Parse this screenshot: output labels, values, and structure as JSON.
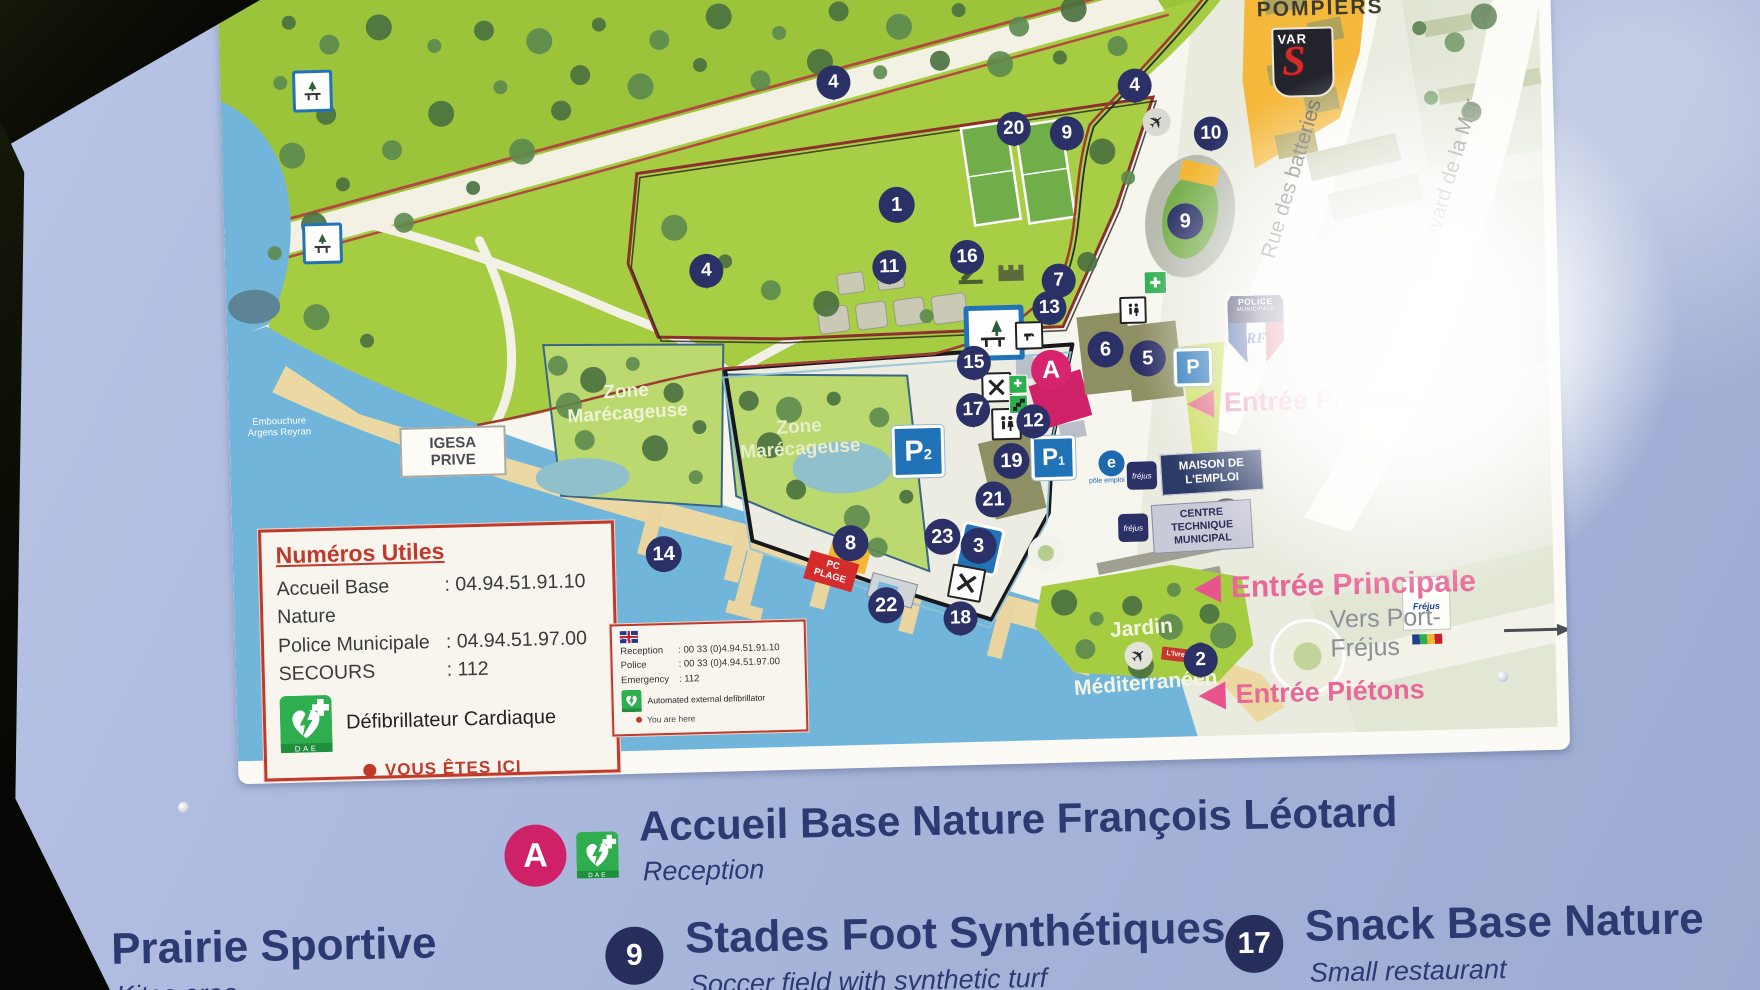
{
  "palette": {
    "panel_blue": "#aebbdf",
    "navy": "#2b3166",
    "legend_navy": "#2c3a72",
    "pink_accent": "#d6246e",
    "entrance_pink": "#e8548c",
    "park_green": "#a6cc41",
    "marsh_green": "#bcd96f",
    "water_blue": "#72b5da",
    "sand": "#ecd8a2",
    "building_yellow": "#f4b83b",
    "parking_blue": "#2173b8",
    "alert_red": "#c0392b",
    "dae_green": "#2fae4f"
  },
  "map": {
    "labels": {
      "pompiers": "POMPIERS",
      "var_logo": "VAR",
      "rue_des_batteries": "Rue des batteries",
      "boulevard_de_la_mer": "Boulevard de la Mer",
      "zone_marecageuse_1": "Zone Marécageuse",
      "zone_marecageuse_2": "Zone Marécageuse",
      "igesa": "IGESA PRIVE",
      "embouchure": "Embouchure Argens Reyran",
      "police_line1": "POLICE",
      "police_line2": "MUNICIPALE",
      "police_rf": "RF",
      "maison_emploi": "MAISON DE L'EMPLOI",
      "centre_technique": "CENTRE TECHNIQUE MUNICIPAL",
      "pole_emploi": "pôle emploi",
      "frejus_small": "fréjus",
      "jardin_line1": "Jardin",
      "jardin_line2": "Méditerranéen",
      "pc_plage": "PC PLAGE",
      "livre_de": "L'îvre de",
      "frejus_logo": "Fréjus",
      "entree_pietons_top": "Entrée Piétons",
      "entree_principale": "Entrée Principale",
      "vers_port_frejus": "Vers Port-Fréjus",
      "entree_pietons_bottom": "Entrée Piétons"
    },
    "info_box": {
      "title": "Numéros Utiles",
      "rows": [
        {
          "label": "Accueil Base Nature",
          "value": ": 04.94.51.91.10"
        },
        {
          "label": "Police Municipale",
          "value": ": 04.94.51.97.00"
        },
        {
          "label": "SECOURS",
          "value": ": 112"
        }
      ],
      "dae_label": "Défibrillateur Cardiaque",
      "dae_logo_text": "DAE",
      "you_are_here": "VOUS ÊTES ICI"
    },
    "info_box_en": {
      "rows": [
        {
          "label": "Reception",
          "value": ": 00 33 (0)4.94.51.91.10"
        },
        {
          "label": "Police",
          "value": ": 00 33 (0)4.94.51.97.00"
        },
        {
          "label": "Emergency",
          "value": ": 112"
        }
      ],
      "dae_label": "Automated external defibrillator",
      "you_are_here": "You are here"
    },
    "markers": [
      {
        "label": "4",
        "kind": "pin",
        "x": 613,
        "y": 109
      },
      {
        "label": "20",
        "kind": "pin",
        "x": 792,
        "y": 160
      },
      {
        "label": "9",
        "kind": "pin",
        "x": 845,
        "y": 166
      },
      {
        "label": "4",
        "kind": "pin",
        "x": 914,
        "y": 120
      },
      {
        "label": "10",
        "kind": "pin",
        "x": 989,
        "y": 170
      },
      {
        "label": "1",
        "kind": "circle",
        "x": 673,
        "y": 233
      },
      {
        "label": "9",
        "kind": "circle",
        "x": 961,
        "y": 257
      },
      {
        "label": "4",
        "kind": "pin",
        "x": 481,
        "y": 294
      },
      {
        "label": "11",
        "kind": "pin",
        "x": 664,
        "y": 295
      },
      {
        "label": "16",
        "kind": "pin",
        "x": 742,
        "y": 287
      },
      {
        "label": "7",
        "kind": "pin",
        "x": 833,
        "y": 313
      },
      {
        "label": "13",
        "kind": "pin",
        "x": 823,
        "y": 340
      },
      {
        "label": "15",
        "kind": "pin",
        "x": 746,
        "y": 393
      },
      {
        "label": "17",
        "kind": "pin",
        "x": 744,
        "y": 440
      },
      {
        "label": "12",
        "kind": "pin",
        "x": 804,
        "y": 453
      },
      {
        "label": "19",
        "kind": "circle",
        "x": 781,
        "y": 492
      },
      {
        "label": "21",
        "kind": "circle",
        "x": 762,
        "y": 530
      },
      {
        "label": "6",
        "kind": "circle",
        "x": 878,
        "y": 383
      },
      {
        "label": "5",
        "kind": "circle",
        "x": 920,
        "y": 393
      },
      {
        "label": "14",
        "kind": "circle",
        "x": 431,
        "y": 576
      },
      {
        "label": "8",
        "kind": "circle",
        "x": 618,
        "y": 570
      },
      {
        "label": "23",
        "kind": "circle",
        "x": 710,
        "y": 566
      },
      {
        "label": "3",
        "kind": "circle",
        "x": 746,
        "y": 576
      },
      {
        "label": "22",
        "kind": "circle",
        "x": 652,
        "y": 633
      },
      {
        "label": "18",
        "kind": "pin",
        "x": 726,
        "y": 648
      },
      {
        "label": "2",
        "kind": "pin",
        "x": 965,
        "y": 696
      },
      {
        "label": "A",
        "kind": "pin-pink",
        "x": 823,
        "y": 402
      }
    ],
    "parking": [
      {
        "label": "P",
        "sub": "",
        "x": 965,
        "y": 403,
        "size": 32
      },
      {
        "label": "P",
        "sub": "1",
        "x": 823,
        "y": 490,
        "size": 38
      },
      {
        "label": "P",
        "sub": "2",
        "x": 688,
        "y": 480,
        "size": 46
      }
    ]
  },
  "legend": {
    "header": {
      "badge": "A",
      "title": "Accueil Base Nature François Léotard",
      "subtitle": "Reception"
    },
    "items": [
      {
        "badge": "1",
        "title": "Prairie Sportive",
        "subtitle": "Kites area"
      },
      {
        "badge": "9",
        "title": "Stades Foot Synthétiques",
        "subtitle": "Soccer field with synthetic turf"
      },
      {
        "badge": "17",
        "title": "Snack Base Nature",
        "subtitle": "Small restaurant"
      }
    ]
  }
}
